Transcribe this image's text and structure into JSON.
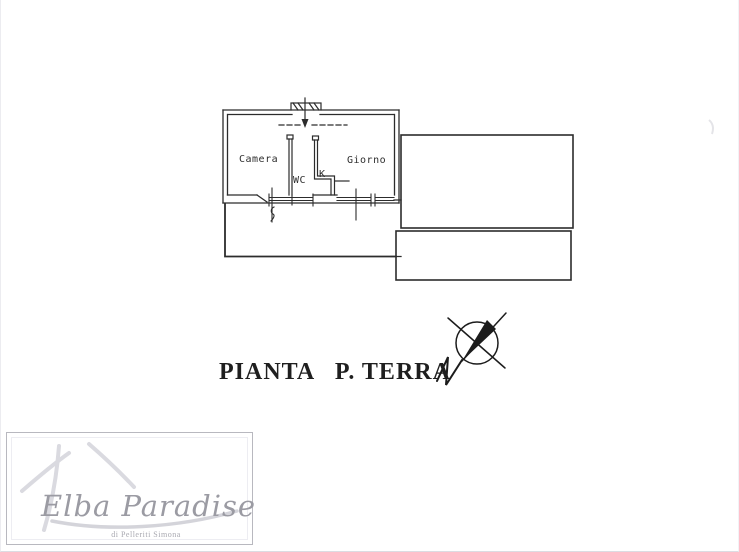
{
  "document": {
    "title": "PIANTA   P. TERRA"
  },
  "floor_plan": {
    "rooms": {
      "camera": "Camera",
      "giorno": "Giorno",
      "wc": "WC",
      "kitchen": "K"
    },
    "compass_letter": "N"
  },
  "watermark": {
    "brand": "Elba Paradise",
    "subtitle": "di Pelleriti Simona"
  },
  "colors": {
    "ink": "#2c2c2c",
    "watermark_text": "#9b9ba3",
    "watermark_stroke": "#dadae0",
    "background": "#ffffff"
  }
}
